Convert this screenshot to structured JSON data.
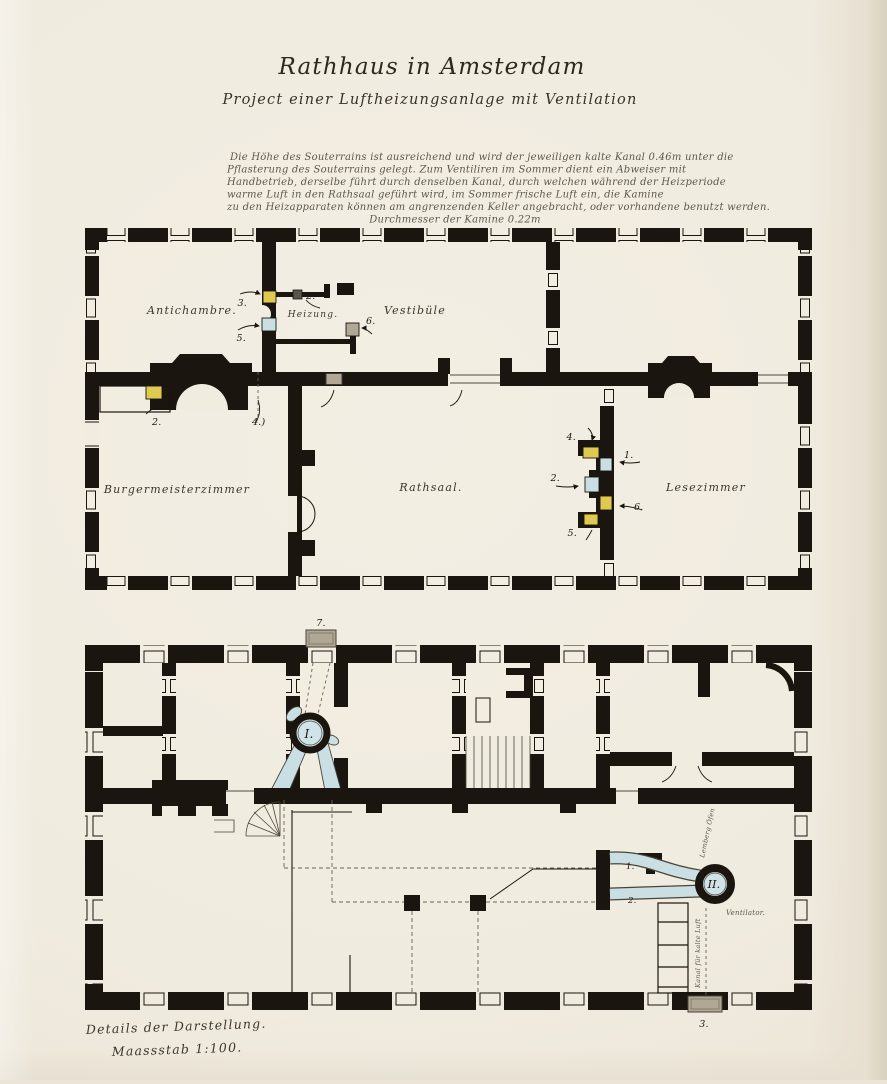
{
  "document": {
    "title": "Rathhaus in Amsterdam",
    "subtitle": "Project einer Luftheizungsanlage mit Ventilation",
    "description_lines": [
      "Die Höhe des Souterrains ist ausreichend und wird der jeweiligen kalte Kanal 0.46m unter die",
      "Pflasterung des Souterrains gelegt. Zum Ventiliren im Sommer dient ein Abweiser mit",
      "Handbetrieb, derselbe führt durch denselben Kanal, durch welchen während der Heizperiode",
      "warme Luft in den Rathsaal geführt wird, im Sommer frische Luft ein, die Kamine",
      "zu den Heizapparaten können am angrenzenden Keller angebracht, oder vorhandene benutzt werden.",
      "Durchmesser der Kamine 0.22m"
    ],
    "footer_line1": "Details der Darstellung.",
    "footer_line2": "Maassstab 1:100."
  },
  "upper_plan": {
    "rooms": {
      "antichambre": "Antichambre.",
      "heizung": "Heizung.",
      "vestibule": "Vestibüle",
      "buergermeisterzimmer": "Burgermeisterzimmer",
      "rathsaal": "Rathsaal.",
      "lesezimmer": "Lesezimmer"
    },
    "heiz_markers": {
      "n3": "3.",
      "n2": "2.",
      "n5": "5.",
      "n6": "6."
    },
    "kamin_markers": {
      "n2": "2.",
      "n4": "4.)"
    },
    "saal_markers": {
      "n1": "1.",
      "n2": "2.",
      "n4": "4.",
      "n5": "5.",
      "n6": "6."
    }
  },
  "lower_plan": {
    "furnace1_label": "I.",
    "furnace2_label": "II.",
    "outlet_top_label": "7.",
    "outlet_bottom_label": "3.",
    "duct1_label": "1.",
    "duct2_label": "2.",
    "annotation_oven": "Lemberg Öfen",
    "annotation_ventilator": "Ventilator.",
    "annotation_channel": "Kanal für kalte Luft"
  },
  "colors": {
    "paper": "#f1ece0",
    "ink": "#1a150f",
    "duct_blue": "#c9dfe4",
    "accent_yellow": "#e0c94f",
    "neutral_gray": "#b0a795"
  }
}
